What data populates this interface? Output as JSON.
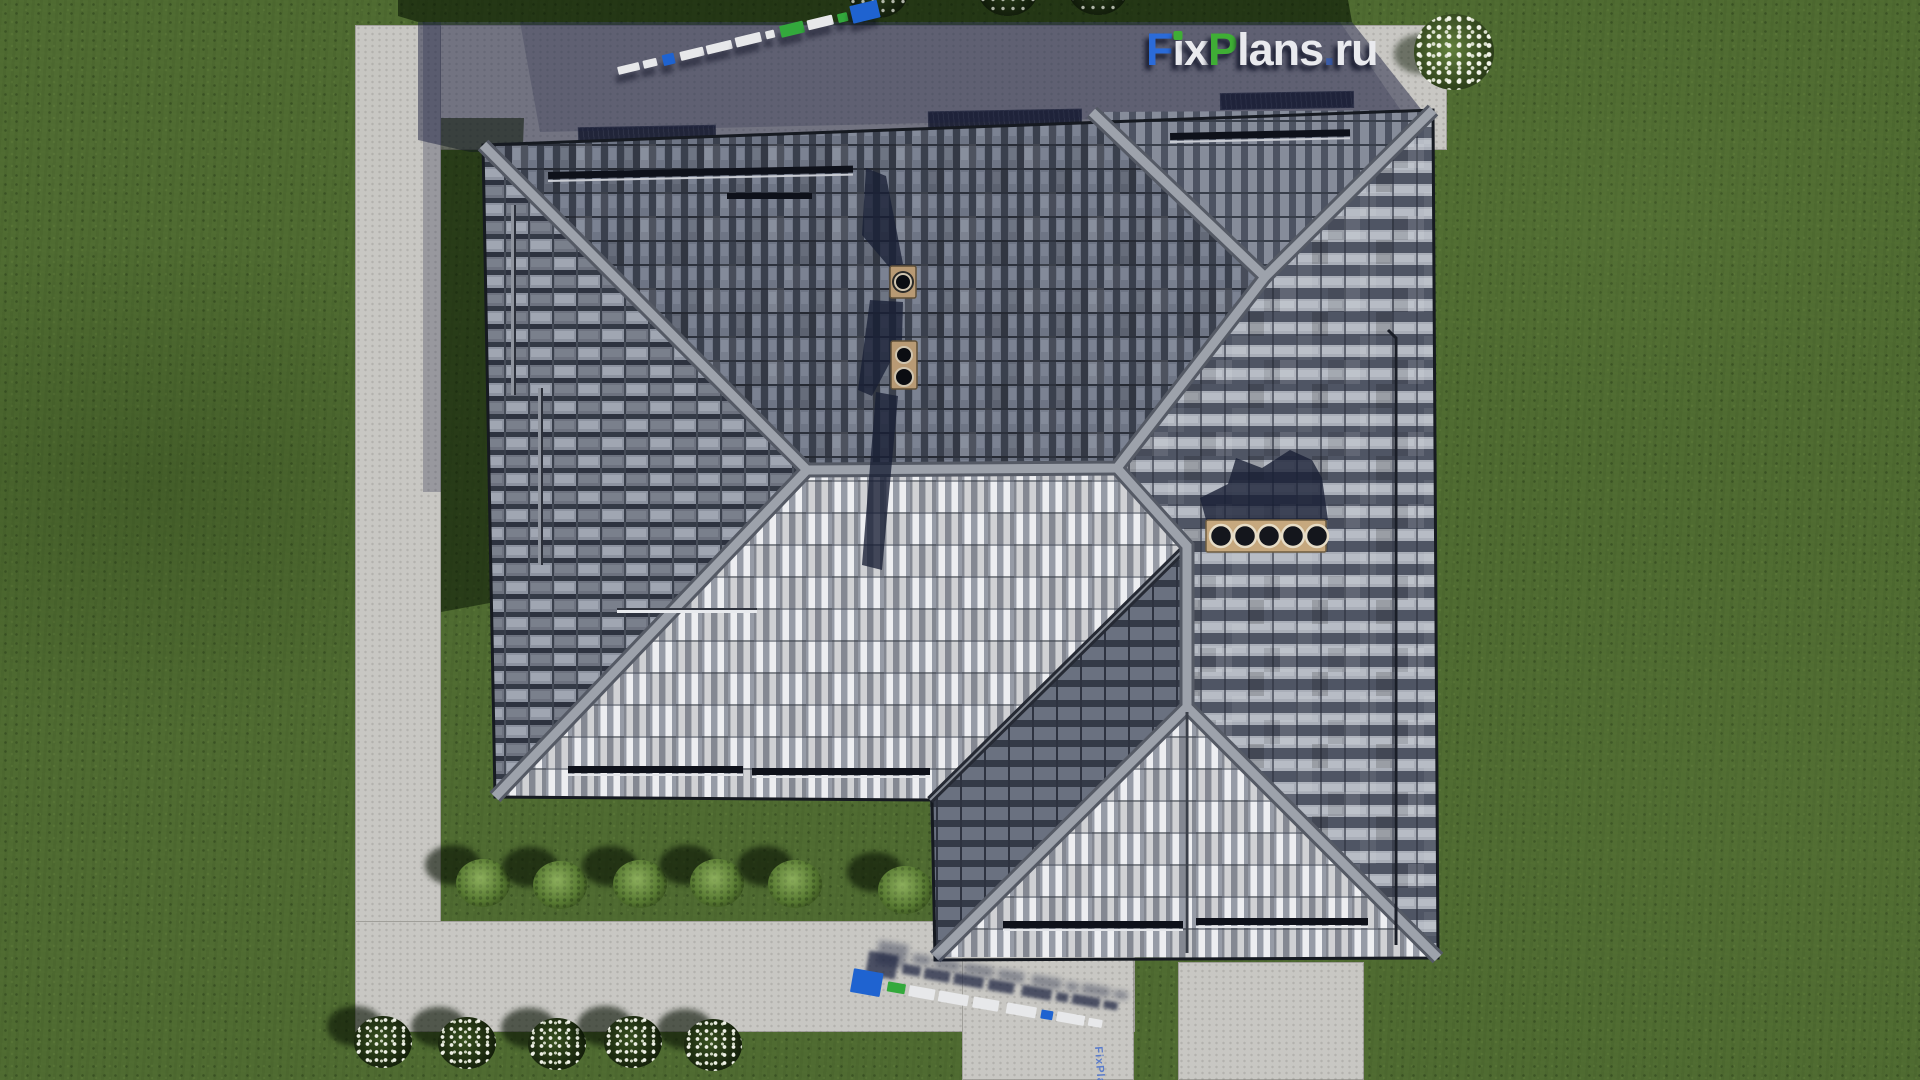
{
  "watermark": {
    "main_text": "FixPlans.ru",
    "tiny_text": "FixPlans.ru"
  },
  "logo": {
    "segments": [
      {
        "text": "F",
        "color": "#2b6bd8"
      },
      {
        "text": "i",
        "color": "#e9eaee",
        "dot": "#3fae35"
      },
      {
        "text": "x",
        "color": "#e9eaee"
      },
      {
        "text": "P",
        "color": "#3fae35"
      },
      {
        "text": "lans",
        "color": "#e9eaee"
      },
      {
        "text": ".",
        "color": "#3b5ca8"
      },
      {
        "text": "ru",
        "color": "#e9eaee"
      }
    ]
  },
  "palette": {
    "white": "#e7e8ea",
    "blue": "#1f63d0",
    "green": "#33a93c",
    "grass": "#4f6b31",
    "path_lit": "#c8c7c3",
    "path_shadow": "#5c617a",
    "roof_dark": "#3b4150",
    "roof_light": "#eef0f2",
    "ridge": "#9da2ab",
    "chimney": "#c6a87e"
  },
  "scene": {
    "green_bushes": [
      [
        483,
        883
      ],
      [
        560,
        885
      ],
      [
        640,
        884
      ],
      [
        717,
        883
      ],
      [
        795,
        884
      ],
      [
        905,
        890
      ]
    ],
    "flower_bushes": [
      [
        383,
        1042
      ],
      [
        467,
        1043
      ],
      [
        557,
        1044
      ],
      [
        633,
        1042
      ],
      [
        713,
        1045
      ]
    ],
    "top_shaded_bushes": [
      [
        878,
        4
      ],
      [
        1008,
        2
      ],
      [
        1098,
        1
      ]
    ],
    "corner_bush": [
      1452,
      52
    ],
    "logo3d_top_blocks": [
      {
        "w": 22,
        "h": 8,
        "c": "white",
        "ml": 0
      },
      {
        "w": 14,
        "h": 8,
        "c": "white",
        "ml": 4
      },
      {
        "w": 12,
        "h": 11,
        "c": "blue",
        "ml": 6
      },
      {
        "w": 24,
        "h": 9,
        "c": "white",
        "ml": 6
      },
      {
        "w": 26,
        "h": 9,
        "c": "white",
        "ml": 3
      },
      {
        "w": 26,
        "h": 10,
        "c": "white",
        "ml": 4
      },
      {
        "w": 9,
        "h": 8,
        "c": "white",
        "ml": 5
      },
      {
        "w": 24,
        "h": 12,
        "c": "green",
        "ml": 6
      },
      {
        "w": 26,
        "h": 10,
        "c": "white",
        "ml": 4
      },
      {
        "w": 10,
        "h": 9,
        "c": "green",
        "ml": 5
      },
      {
        "w": 28,
        "h": 18,
        "c": "blue",
        "ml": 4
      }
    ],
    "logo3d_bottom_blocks": [
      {
        "w": 30,
        "h": 24,
        "c": "blue",
        "ml": 0
      },
      {
        "w": 18,
        "h": 10,
        "c": "green",
        "ml": 6
      },
      {
        "w": 26,
        "h": 11,
        "c": "white",
        "ml": 4
      },
      {
        "w": 30,
        "h": 11,
        "c": "white",
        "ml": 4
      },
      {
        "w": 26,
        "h": 11,
        "c": "white",
        "ml": 5
      },
      {
        "w": 30,
        "h": 11,
        "c": "white",
        "ml": 8
      },
      {
        "w": 12,
        "h": 9,
        "c": "blue",
        "ml": 5
      },
      {
        "w": 28,
        "h": 10,
        "c": "white",
        "ml": 4
      },
      {
        "w": 14,
        "h": 8,
        "c": "white",
        "ml": 4
      }
    ]
  }
}
